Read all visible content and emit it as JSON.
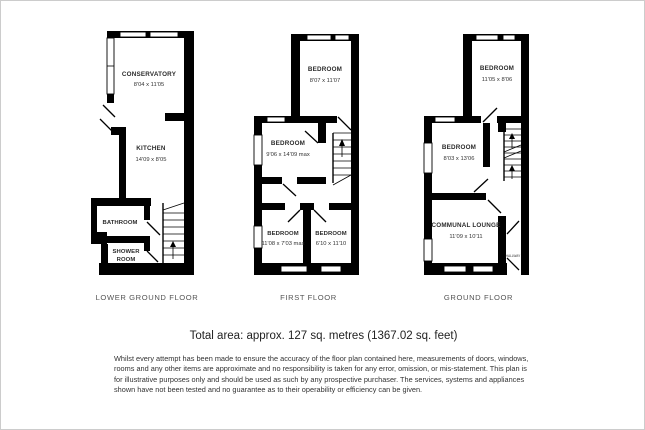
{
  "floors": {
    "lower_ground": {
      "label": "LOWER GROUND FLOOR",
      "conservatory": {
        "name": "CONSERVATORY",
        "dims": "8'04 x 11'05"
      },
      "kitchen": {
        "name": "KITCHEN",
        "dims": "14'09 x 8'05"
      },
      "bathroom": {
        "name": "BATHROOM"
      },
      "shower_line1": "SHOWER",
      "shower_line2": "ROOM"
    },
    "first": {
      "label": "FIRST FLOOR",
      "bedroom_top": {
        "name": "BEDROOM",
        "dims": "8'07 x 11'07"
      },
      "bedroom_mid": {
        "name": "BEDROOM",
        "dims": "9'06 x 14'09 max"
      },
      "bedroom_bottom_left": {
        "name": "BEDROOM",
        "dims": "11'08 x 7'03 max"
      },
      "bedroom_bottom_right": {
        "name": "BEDROOM",
        "dims": "6'10 x 11'10"
      }
    },
    "ground": {
      "label": "GROUND FLOOR",
      "bedroom_top": {
        "name": "BEDROOM",
        "dims": "11'05 x 8'06"
      },
      "bedroom_mid": {
        "name": "BEDROOM",
        "dims": "8'03 x 13'06"
      },
      "lounge": {
        "name": "COMMUNAL LOUNGE",
        "dims": "11'09 x 10'11"
      },
      "hallway": "HALLWAY"
    }
  },
  "footer": {
    "total_area": "Total area: approx. 127 sq. metres (1367.02 sq. feet)",
    "disclaimer_lines": [
      "Whilst every attempt has been made to ensure the accuracy of the floor plan contained here, measurements of doors, windows,",
      "rooms and any other items are approximate and no responsibility is taken for any error, omission, or mis-statement. This plan is",
      "for illustrative purposes only and should be used as such by any prospective purchaser. The services, systems and appliances",
      "shown have not been tested and no guarantee  as to their operability or efficiency can be given."
    ]
  },
  "colors": {
    "wall": "#000000",
    "text": "#333333",
    "background": "#ffffff"
  }
}
